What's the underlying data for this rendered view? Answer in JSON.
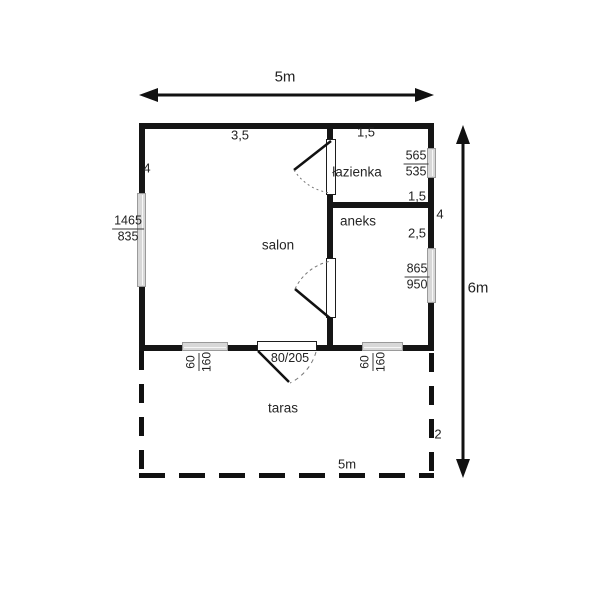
{
  "plan": {
    "overall": {
      "width_top": "5m",
      "height_right": "6m",
      "width_bottom": "5m"
    },
    "rooms": {
      "salon": "salon",
      "bathroom": "łazienka",
      "kitchenette": "aneks",
      "terrace": "taras"
    },
    "dims": {
      "salon_top_span": "3,5",
      "bathroom_top_span": "1,5",
      "left_wall": "4",
      "bathroom_right": "1,5",
      "right_wall_mid": "4",
      "kitchenette_right": "2,5",
      "terrace_depth": "2"
    },
    "door": {
      "terrace_door_size": "80/205"
    },
    "windows": {
      "left": {
        "top": "1465",
        "bottom": "835"
      },
      "bathroom": {
        "top": "565",
        "bottom": "535"
      },
      "kitchenette": {
        "top": "865",
        "bottom": "950"
      },
      "bottom_left": {
        "top": "60",
        "bottom": "160"
      },
      "bottom_right": {
        "top": "60",
        "bottom": "160"
      }
    },
    "colors": {
      "wall": "#151515",
      "window_fill": "#d8d8d8",
      "text": "#222222"
    }
  }
}
